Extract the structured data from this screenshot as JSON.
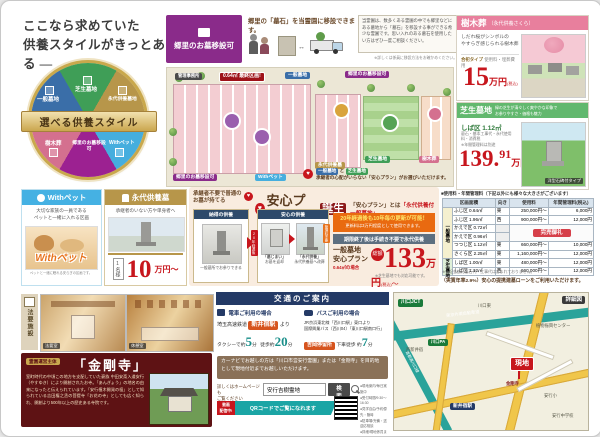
{
  "headline": {
    "line1": "ここなら求めていた",
    "line2": "供養スタイルがきっとある —"
  },
  "wheel": {
    "center": "選べる供養スタイル",
    "sectors": [
      "一般墓地",
      "芝生墓地",
      "永代供養墓地",
      "樹木葬",
      "郷里のお墓移設可",
      "Withペット"
    ]
  },
  "relocation": {
    "title": "郷里のお墓移設可",
    "lead": "郷里の「墓石」を当霊園に移設できます。",
    "note": "当霊園は、数多くある霊園の中でも郷里などにある墓地から「墓石」を移設する事ができる希少な霊園です。思い入れのある墓石を使用したい方はぜひ一度ご相談ください。",
    "caption": "※詳しくは係員に移設方法をお確かめください。"
  },
  "sitemap": {
    "office": "管理事務所",
    "last_plot": "0.64㎡ 最終区画!",
    "b_ippan": "一般墓地",
    "b_relocation_top": "郷里のお墓移設可",
    "b_eitai": "永代供養墓",
    "b_shibafu": "芝生墓地",
    "b_jumoku": "樹木葬",
    "b_withpet": "Withペット",
    "b_relocation_btm": "郷里のお墓移設可",
    "note_pill1": "一般墓地",
    "note_and": "と",
    "note_pill2": "芝生墓地",
    "note_text": "承継者の心配がいらない「安心プラン」がお選びいただけます。"
  },
  "jumokuso": {
    "title": "樹木葬",
    "subtitle": "（永代供養さくら）",
    "desc1": "しだれ桜がシンボルの",
    "desc2": "やすらぎ感じられる樹木葬",
    "plan": "合祀タイプ",
    "plan_note": "使用料・埋葬費用",
    "price_num": "15",
    "price_unit": "万円",
    "price_tax": "(税込)"
  },
  "shibafu": {
    "title": "芝生墓地",
    "desc1": "緑の芝生が清々しく爽やかな印象で",
    "desc2": "お参りやすさ・価格も魅力",
    "plot": "しば区 1.12㎡",
    "includes1": "墓石・基本工事代・永代使用料・消費税",
    "includes2": "※年間管理料は別途",
    "price_int": "139.",
    "price_dec": "91",
    "price_unit": "万円",
    "price_tail": "(税込)〜",
    "photo_caption": "洋型石碑付タイプ"
  },
  "price_table": {
    "title": "■使用料・年間管理料（下記以外にも様々な大きさがございます）",
    "headers": {
      "h1": "区画面積",
      "h2": "向き",
      "h3": "使用料",
      "h4": "年間管理料(税込)"
    },
    "group1": "一般墓地",
    "group2": "芝生墓地",
    "rows": [
      {
        "plot": "ふじ区 0.64㎡",
        "dir": "東",
        "fee": "250,000円〜",
        "admin": "6,000円"
      },
      {
        "plot": "ふじ区 1.96㎡",
        "dir": "西",
        "fee": "900,000円〜",
        "admin": "12,000円"
      },
      {
        "plot": "かえで区 0.72㎡",
        "dir": "",
        "fee": "",
        "admin": ""
      },
      {
        "plot": "かえで区 0.96㎡",
        "dir": "",
        "fee": "",
        "admin": ""
      },
      {
        "plot": "つつじ区 1.12㎡",
        "dir": "東",
        "fee": "660,000円〜",
        "admin": "10,000円"
      },
      {
        "plot": "さくら区 2.25㎡",
        "dir": "東",
        "fee": "1,160,000円〜",
        "admin": "12,000円"
      },
      {
        "plot": "しば区 1.00㎡",
        "dir": "東",
        "fee": "480,000円〜",
        "admin": "12,000円"
      },
      {
        "plot": "しば区 1.12㎡",
        "dir": "西",
        "fee": "660,000円〜",
        "admin": "12,000円"
      }
    ],
    "soldout": "完売御礼",
    "footnote": "※上記金額に墓石代・工事代は含まれておりません。",
    "loan": "（実質年率2.9%）安心の提携建墓ローンをご利用いただけます。"
  },
  "withpet": {
    "title": "Withペット",
    "desc1": "大切な家族の一員である",
    "desc2": "ペットと一緒に入れる区画",
    "logo": "Withペット",
    "tagline": "ペットと一緒に眠れる安らぎの区画です。"
  },
  "eitai": {
    "title": "永代供養墓",
    "desc": "承継者のいない方や単身者へ",
    "price_label": "1名様",
    "price_num": "10",
    "price_unit": "万円〜"
  },
  "anshin": {
    "lead1": "承継者不要で普通の",
    "lead2": "お墓が持てる",
    "boxA_header": "納得の供養",
    "boxA_caption": "一般墓所でお参りできる",
    "title": "安心プラン",
    "title2": "誕生",
    "subtitle_pre": "「安心プラン」とは",
    "subtitle_em": "「永代供養付一般墓地」",
    "boxB_header": "安心の供養",
    "arrow_label": "20年経過後",
    "img1_title": "「墓じまい」",
    "img1_caption": "お墓を返却",
    "img2_title": "「永代供養」",
    "img2_caption": "永代供養墓へ改葬",
    "tag": "管理料不要",
    "orange1": "20年経過後も10年毎の更新が可能！",
    "orange2": "更新料は3万円程度として使用できます。",
    "gray_line": "期限終了後は手続き不要で永代供養",
    "price_t1": "一般墓地",
    "price_t2": "安心プラン",
    "price_sub": "0.64㎡の場合",
    "price_badge": "総額",
    "price_num": "133",
    "price_unit": "万円",
    "price_tax": "(税込)",
    "price_tail": "〜",
    "price_note": "※芝生墓地でも対応可能です。"
  },
  "houyou": {
    "label": "法要施設",
    "photo1": "法要室",
    "photo2": "休憩室"
  },
  "kongoji": {
    "badge": "霊園運営主体",
    "title": "「金剛寺」",
    "body": "室町時代の中頃この地方を支配していた豪族 中田安斎入道安行（やすゆき）により開創されたお寺。「あんぎょう」の地名の由来になったと伝えられています。「安行植木開発の祖」として知られている吉田権之丞の菩提寺「お花の寺」としても広く知られ、開創より500年以上の歴史ある寺院です。"
  },
  "access": {
    "title": "交通のご案内",
    "train_header": "電車ご利用の場合",
    "train_line": "埼玉高速鉄道",
    "train_station": "新井宿駅",
    "train_from": "より",
    "taxi_pre": "タクシーで約",
    "taxi_num": "5",
    "taxi_unit": "分",
    "walk_pre": "徒歩約",
    "walk_num": "20",
    "walk_unit": "分",
    "bus_header": "バスご利用の場合",
    "bus_desc1": "JR京浜東北線「西川口駅」東口より",
    "bus_desc2": "国際興業バス〔西川04〕「東川口駅南口行」",
    "bus_stop": "吉岡停留所",
    "bus_walk_pre": "下車徒歩 約",
    "bus_walk_num": "7",
    "bus_walk_unit": "分",
    "navi": "カーナビでお越しの方は「川口市営安行霊園」または「金剛寺」を目的地として現地付近までお越しいただけます。",
    "web1": "詳しくはホームページも",
    "web2": "ご覧ください",
    "search_value": "安行吉樹霊地",
    "search_button": "検索",
    "movie1": "動画",
    "movie2": "配信中!",
    "qr_label": "QRコードでご覧になれます",
    "notes": [
      "●現地案内/毎日実施中",
      "●受付時間/9:30〜16:30",
      "●見学自由/予約優先・随時",
      "●駐車場/完備・送迎応相談",
      "●詳細/現地係員までどうぞ"
    ]
  },
  "map": {
    "detail": "詳細図",
    "jct": "川口JCT",
    "gaikan": "東京外環自動車道",
    "shuto": "首都高川口線",
    "higashi": "川口東",
    "pa": "川口PA",
    "sta": "新井宿駅",
    "nishi": "西新井宿",
    "genchi": "現地",
    "kongoji": "金剛寺",
    "sho": "安行小",
    "chu": "安行中学校",
    "center": "植物振興センター"
  },
  "colors": {
    "accent_red": "#c7161d",
    "gold": "#b2924a",
    "navy": "#243a66",
    "teal": "#2aa39a"
  }
}
